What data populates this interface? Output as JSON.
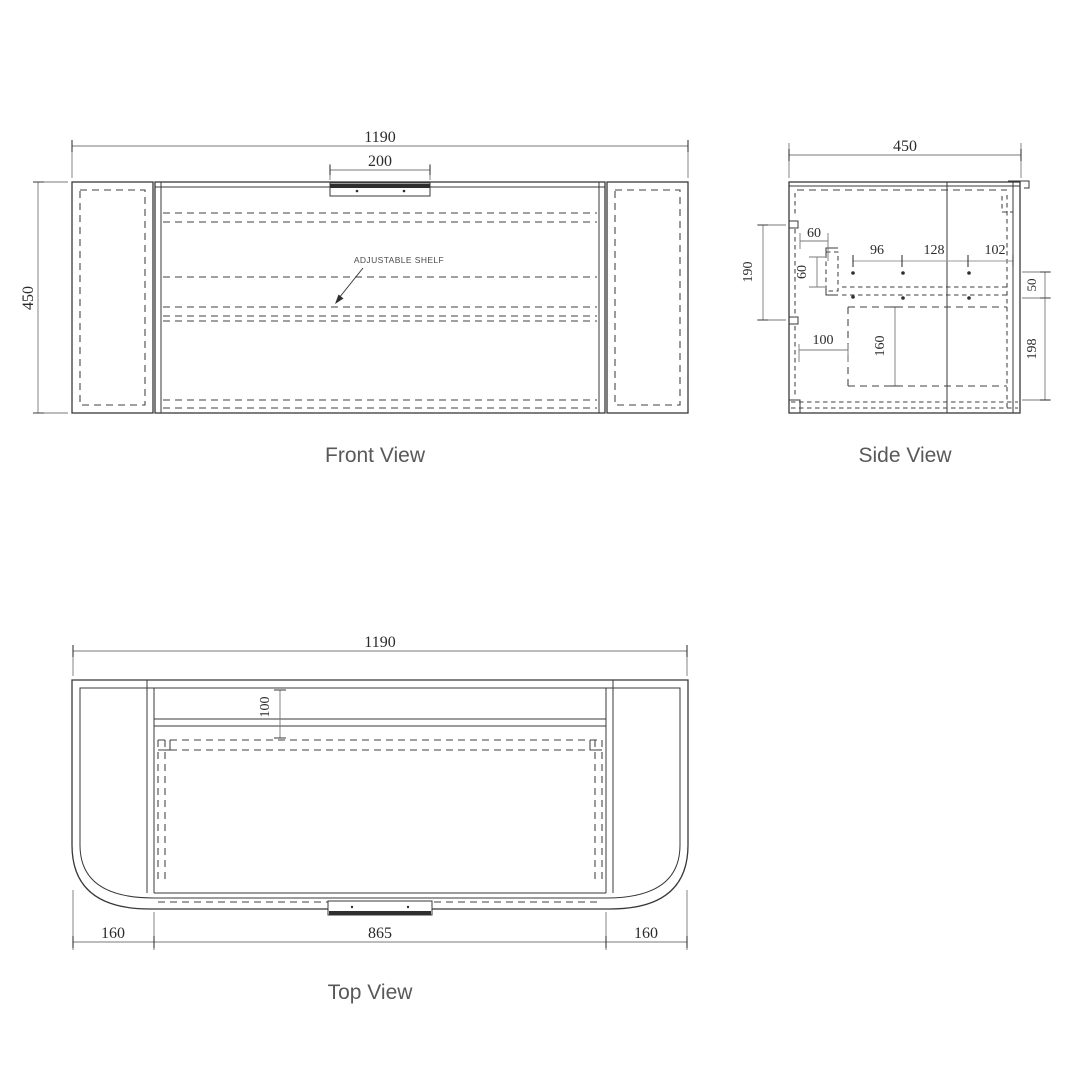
{
  "colors": {
    "background": "#ffffff",
    "line": "#383838",
    "hidden_line": "#404040",
    "dimension_line": "#787878",
    "dim_text": "#2b2b2b",
    "label_text": "#595959"
  },
  "views": {
    "front": {
      "label": "Front View",
      "annotation": "ADJUSTABLE SHELF",
      "dims": {
        "overall_width": "1190",
        "handle_width": "200",
        "height": "450"
      }
    },
    "side": {
      "label": "Side View",
      "dims": {
        "depth": "450",
        "back_panel_drop": "190",
        "top_offset_h": "60",
        "top_offset_v": "60",
        "pitch_a": "96",
        "pitch_b": "128",
        "pitch_c": "102",
        "front_gap": "50",
        "base_offset": "100",
        "drawer_depth": "160",
        "lower_drop": "198"
      }
    },
    "top": {
      "label": "Top View",
      "dims": {
        "overall_width": "1190",
        "back_clearance": "100",
        "left_overhang": "160",
        "carcass_width": "865",
        "right_overhang": "160"
      }
    }
  }
}
